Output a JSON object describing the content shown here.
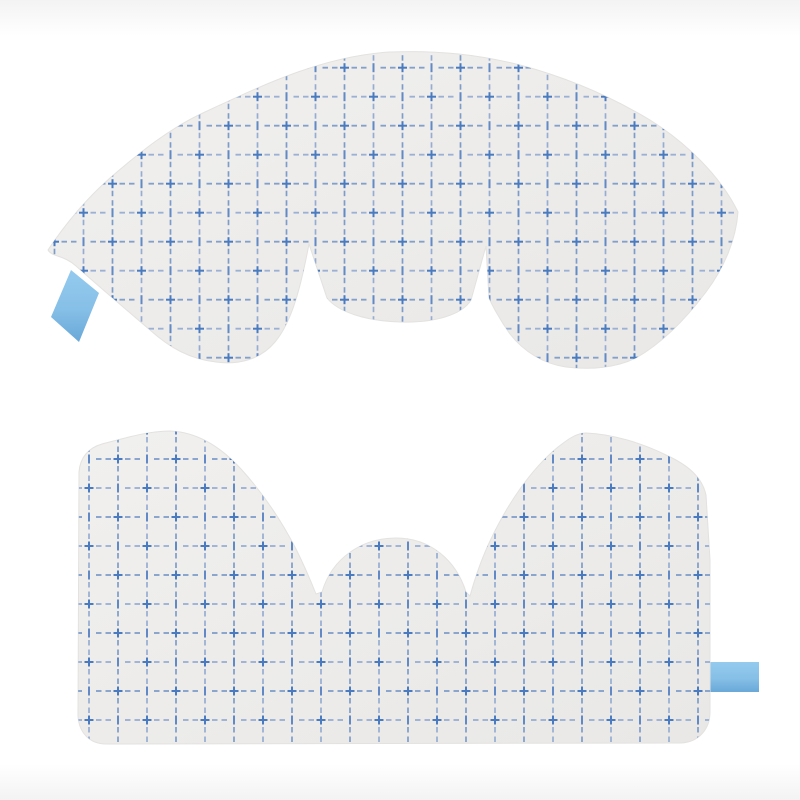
{
  "image": {
    "description": "Product photo of two transparent adhesive film wound dressings (incise drapes) printed with a blue dashed measurement grid, each with a light blue pull tab",
    "top_piece": "fan-shaped film drape with center lobe and two relief slits, pull tab at lower left",
    "bottom_piece": "rectangular film drape with two shoulder humps, center dome and two relief slits, pull tab at right edge"
  },
  "colors": {
    "bg_white": "#ffffff",
    "bg_band": "#f3f3f3",
    "film_light": "#f1f0ee",
    "film_dark": "#e9e8e6",
    "film_edge": "#e3e2e0",
    "grid_plus": "#4a7bc0",
    "grid_bar": "#6089c5",
    "grid_dash": "#7d9cc9",
    "grid_dash_light": "#96add3",
    "tab_light": "#94caee",
    "tab_mid": "#86bfe7",
    "tab_dark": "#69a8d8"
  }
}
